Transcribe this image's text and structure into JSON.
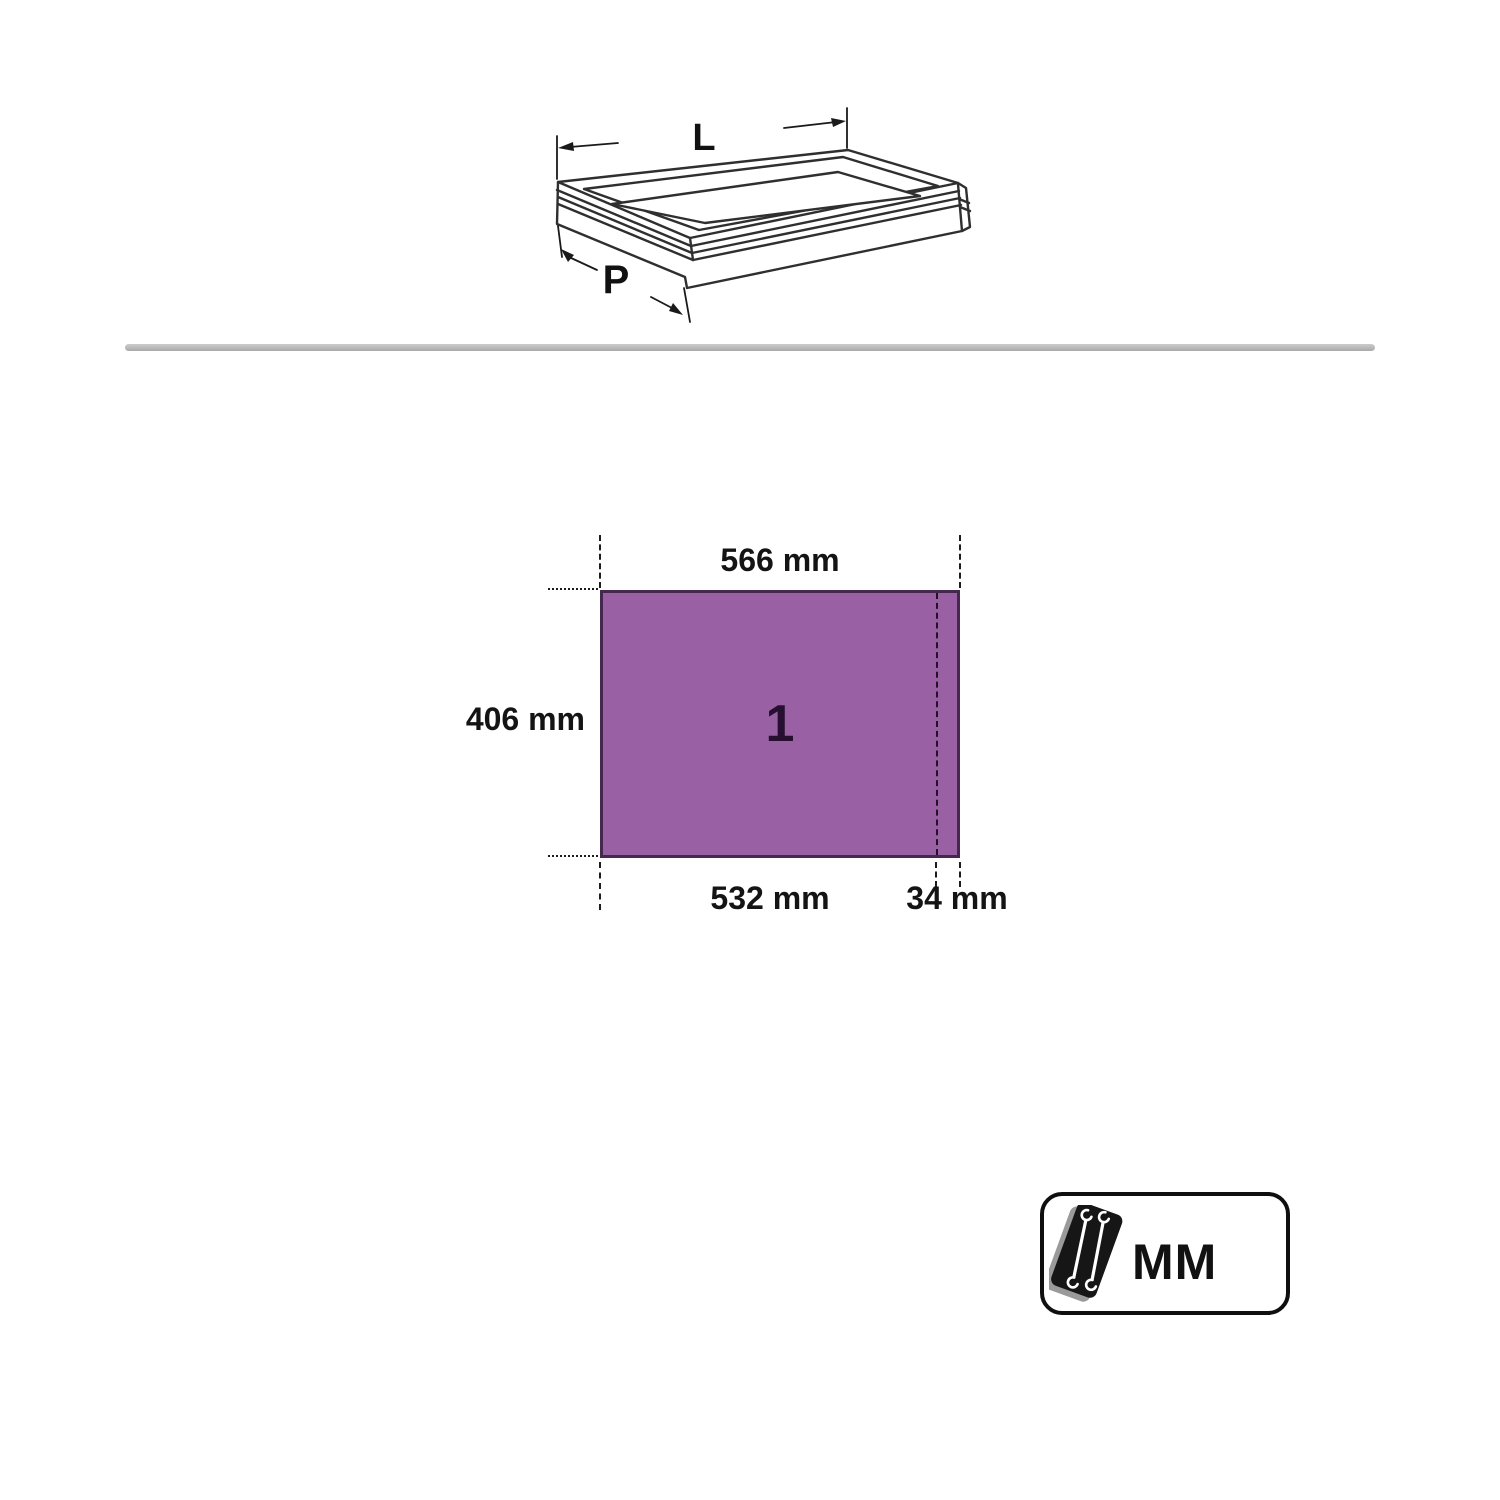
{
  "drawer_diagram": {
    "length_label": "L",
    "depth_label": "P"
  },
  "dimension_diagram": {
    "top_width_label": "566 mm",
    "left_height_label": "406 mm",
    "bottom_inner_width_label": "532 mm",
    "bottom_offset_label": "34 mm",
    "drawer_number": "1",
    "fill_color": "#9960a4",
    "border_color": "#46284f"
  },
  "unit_badge": {
    "label": "MM",
    "icon": "wrench-set-icon"
  }
}
